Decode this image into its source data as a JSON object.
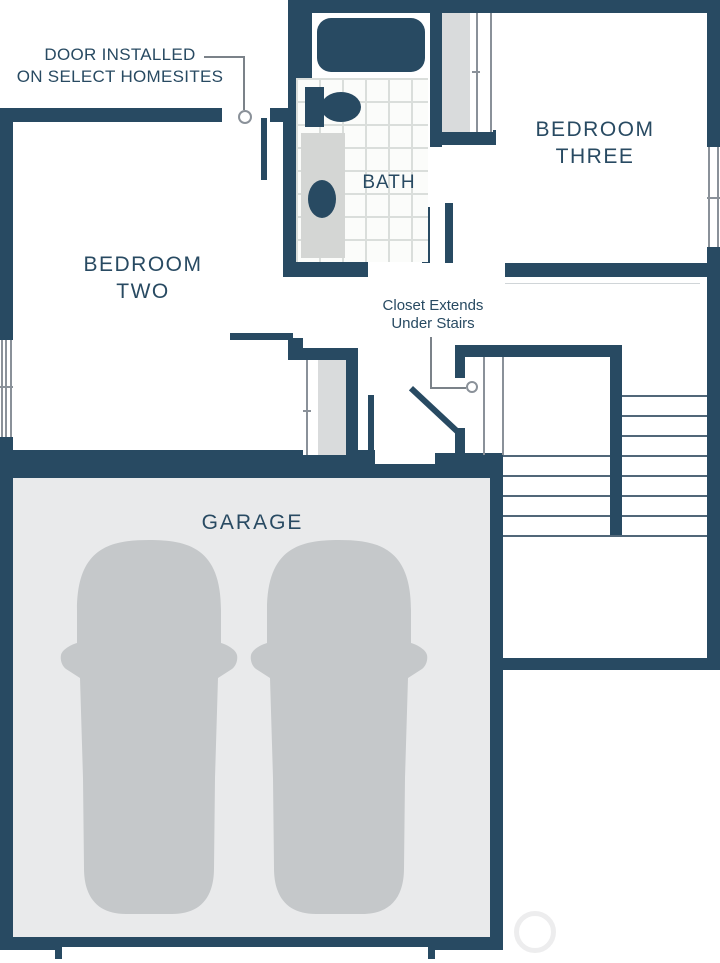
{
  "rooms": {
    "bedroom_two": {
      "line1": "BEDROOM",
      "line2": "TWO"
    },
    "bedroom_three": {
      "line1": "BEDROOM",
      "line2": "THREE"
    },
    "bath": {
      "label": "BATH"
    },
    "garage": {
      "label": "GARAGE"
    }
  },
  "annotations": {
    "door_note": {
      "line1": "DOOR INSTALLED",
      "line2": "ON SELECT HOMESITES"
    },
    "closet_note": {
      "line1": "Closet Extends",
      "line2": "Under Stairs"
    }
  },
  "colors": {
    "wall": "#284a62",
    "text": "#284a62",
    "tile_line": "#dadedb",
    "closet_fill": "#d9dbdc",
    "vanity_fill": "#d4d6d4",
    "garage_floor": "#e9eaeb",
    "car": "#c5c8ca",
    "thin_line": "#8a9199",
    "tread_line": "#516779",
    "leader_line": "#7b8289",
    "watermark": "#ededee"
  }
}
